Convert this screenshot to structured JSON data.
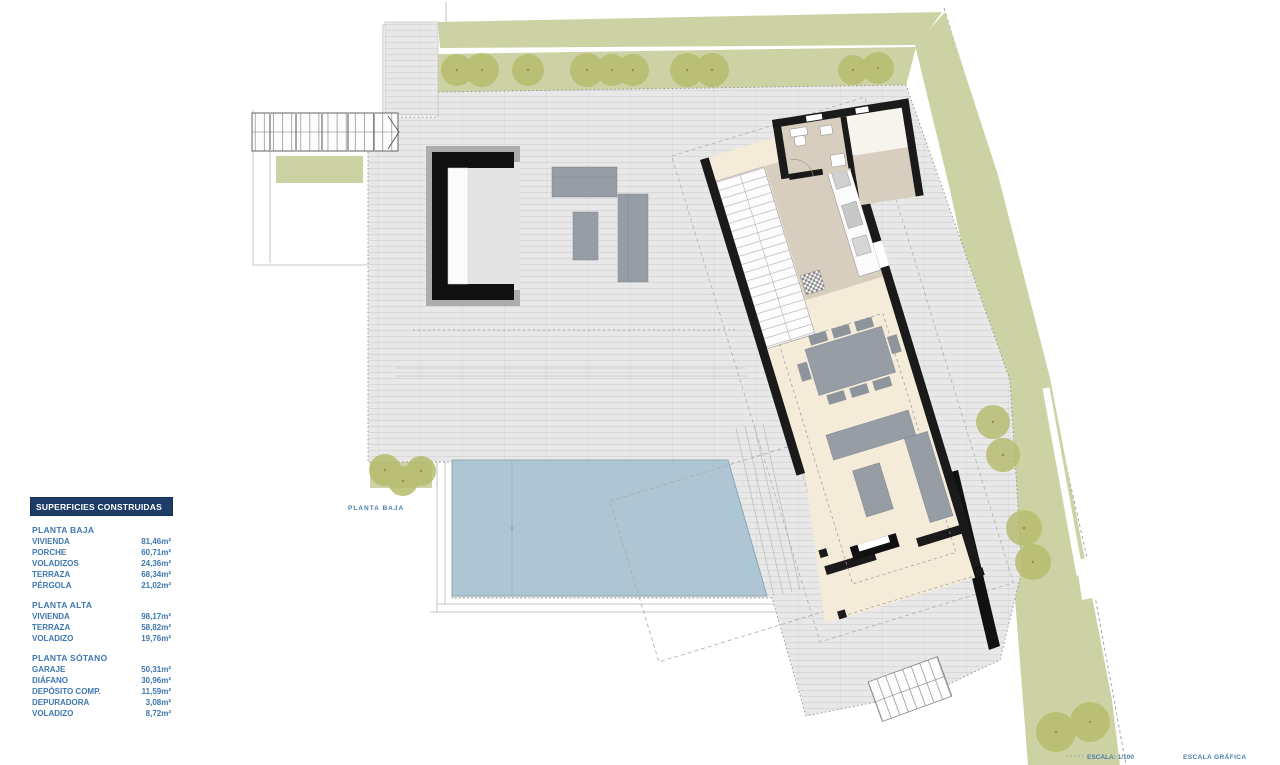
{
  "page": {
    "width": 1280,
    "height": 765,
    "background": "#ffffff"
  },
  "plan": {
    "label": "PLANTA BAJA",
    "scale_label": "ESCALA:  1/100",
    "graphic_scale_label": "ESCALA GRÁFICA"
  },
  "legend": {
    "header": "SUPERFICIES CONSTRUIDAS",
    "sections": [
      {
        "title": "PLANTA BAJA",
        "items": [
          {
            "label": "VIVIENDA",
            "value": "81,46m²"
          },
          {
            "label": "PORCHE",
            "value": "60,71m²"
          },
          {
            "label": "VOLADIZOS",
            "value": "24,36m²"
          },
          {
            "label": "TERRAZA",
            "value": "68,34m²"
          },
          {
            "label": "PÉRGOLA",
            "value": "21,02m²"
          }
        ]
      },
      {
        "title": "PLANTA ALTA",
        "items": [
          {
            "label": "VIVIENDA",
            "value": "98,17m²"
          },
          {
            "label": "TERRAZA",
            "value": "58,82m²"
          },
          {
            "label": "VOLADIZO",
            "value": "19,76m²"
          }
        ]
      },
      {
        "title": "PLANTA SÓTANO",
        "items": [
          {
            "label": "GARAJE",
            "value": "50,31m²"
          },
          {
            "label": "DIÁFANO",
            "value": "30,96m²"
          },
          {
            "label": "DEPÓSITO COMP.",
            "value": "11,59m²"
          },
          {
            "label": "DEPURADORA",
            "value": "3,08m²"
          },
          {
            "label": "VOLADIZO",
            "value": "8,72m²"
          }
        ]
      }
    ]
  },
  "colors": {
    "page_bg": "#ffffff",
    "legend_header_bg": "#1d3d66",
    "legend_text": "#3d77b0",
    "plan_label_blue": "#4a7fae",
    "garden_green": "#cdd2a4",
    "tree_green": "#b6bb6d",
    "pool_blue": "#aec5d3",
    "deck_gray": "#e8e8e8",
    "floor_cream": "#f4ebd9",
    "bath_taupe": "#d8cec0",
    "wall_black": "#1a1a1a"
  }
}
